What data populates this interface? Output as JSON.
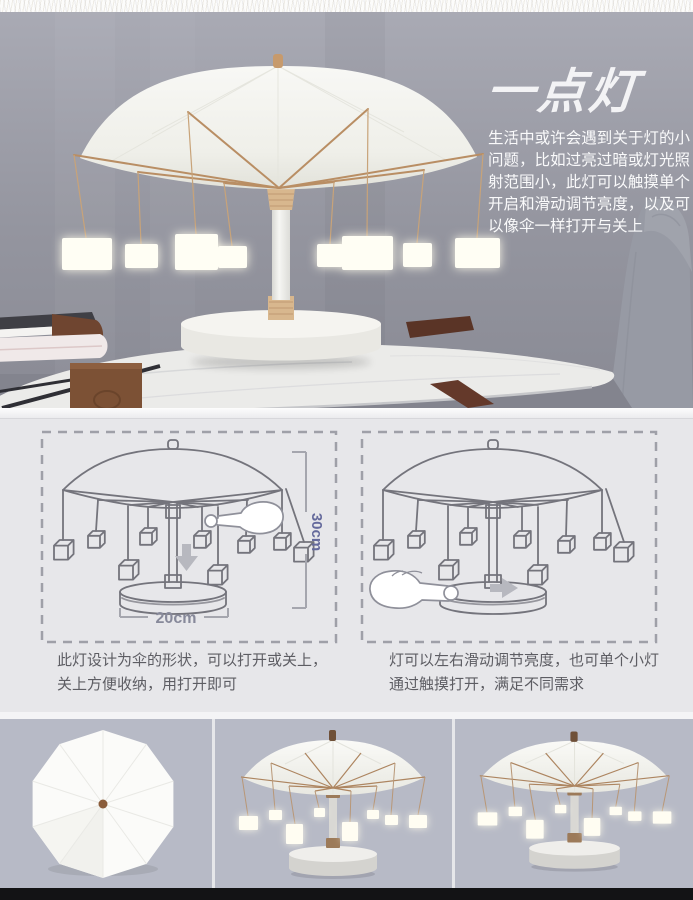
{
  "page": {
    "title": "一点灯",
    "intro": "生活中或许会遇到关于灯的小问题，比如过亮过暗或灯光照射范围小，此灯可以触摸单个开启和滑动调节亮度，以及可以像伞一样打开与关上"
  },
  "diagrams": {
    "left": {
      "caption": "此灯设计为伞的形状，可以打开或关上，关上方便收纳，用打开即可",
      "height_label": "30cm",
      "width_label": "20cm",
      "gesture_icon": "touch-hand",
      "arrow_icon": "arrow-down"
    },
    "right": {
      "caption": "灯可以左右滑动调节亮度，也可单个小灯通过触摸打开，满足不同需求",
      "gesture_icon": "press-hand",
      "arrow_icon": "arrow-right"
    }
  },
  "gallery": {
    "panels": [
      {
        "name": "closed-umbrella-top-view"
      },
      {
        "name": "open-lamp-front-view"
      },
      {
        "name": "open-lamp-wide-view"
      }
    ]
  },
  "colors": {
    "wall": "#95969f",
    "copper_frame": "#b98e64",
    "dimension_blue": "#656a9c",
    "dimension_gray": "#87899a",
    "section_bg": "#e7e7ea",
    "panel_bg": "#b7bac6",
    "footer_bar": "#131315"
  }
}
